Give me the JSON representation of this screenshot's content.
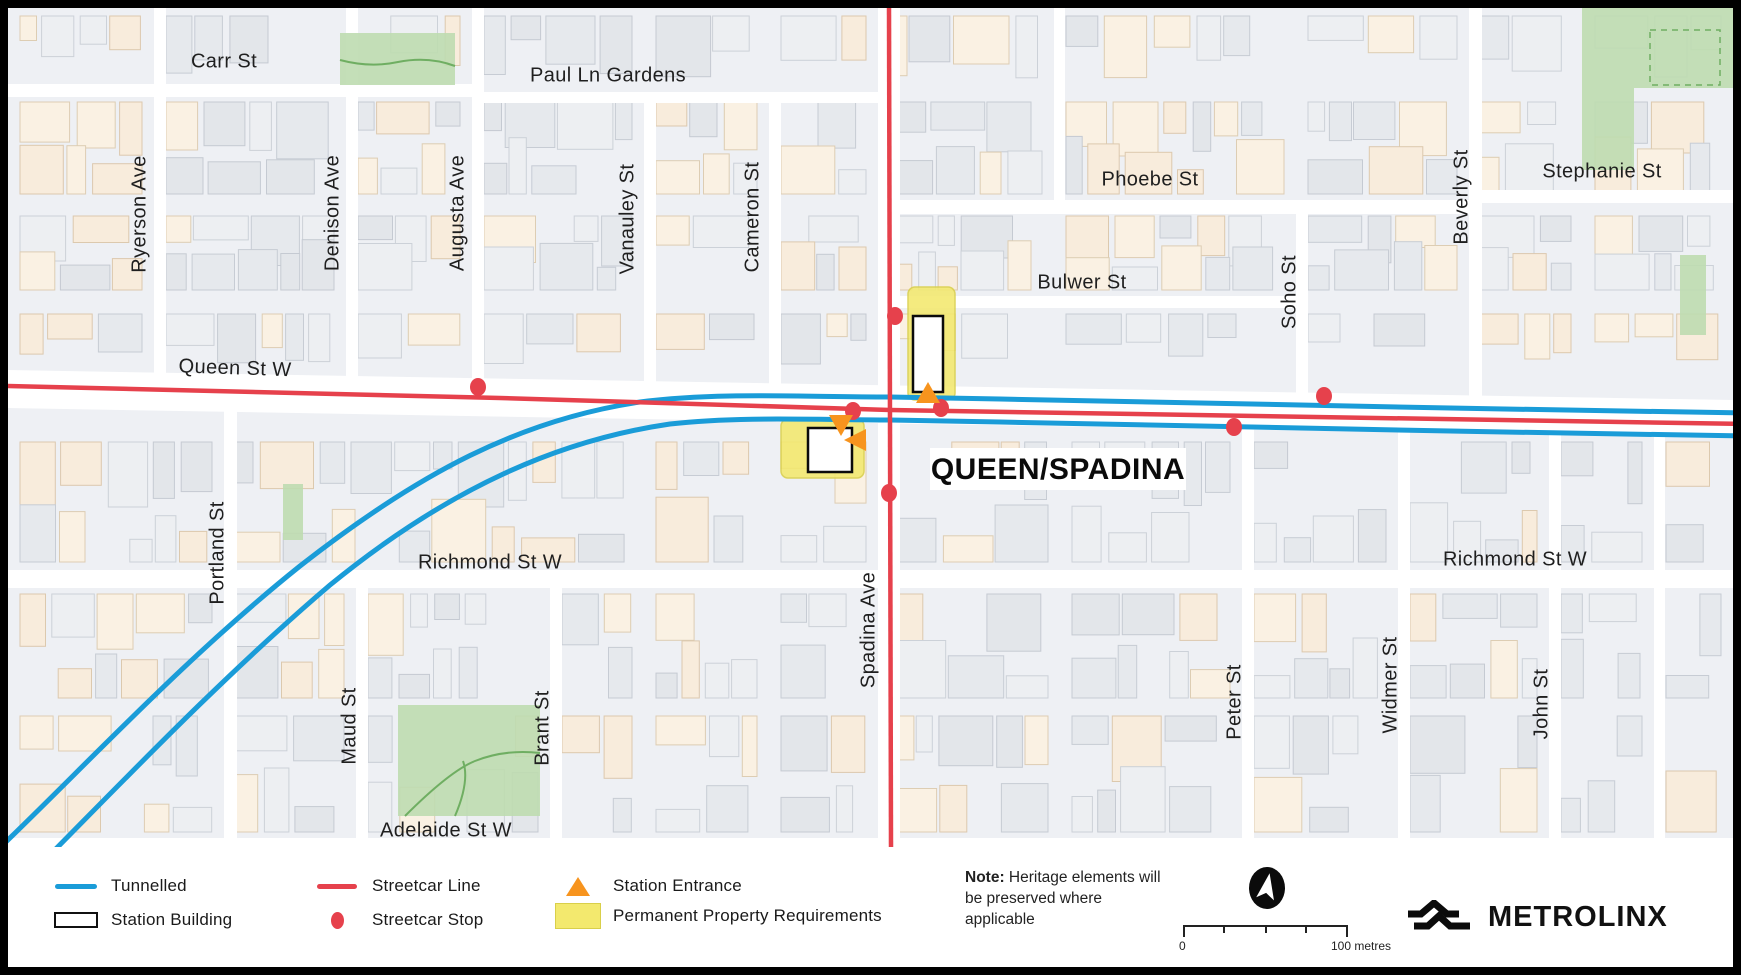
{
  "map": {
    "station_label": "QUEEN/SPADINA",
    "street_labels": [
      {
        "t": "Carr St",
        "x": 224,
        "y": 62,
        "r": 0
      },
      {
        "t": "Paul Ln Gardens",
        "x": 608,
        "y": 76,
        "r": 0
      },
      {
        "t": "Phoebe St",
        "x": 1150,
        "y": 180,
        "r": 0
      },
      {
        "t": "Stephanie St",
        "x": 1602,
        "y": 172,
        "r": 0
      },
      {
        "t": "Bulwer St",
        "x": 1082,
        "y": 283,
        "r": 0
      },
      {
        "t": "Queen St W",
        "x": 235,
        "y": 369,
        "r": 2
      },
      {
        "t": "Richmond St W",
        "x": 490,
        "y": 563,
        "r": 0
      },
      {
        "t": "Richmond St W",
        "x": 1515,
        "y": 560,
        "r": 0
      },
      {
        "t": "Adelaide St W",
        "x": 446,
        "y": 831,
        "r": 0
      },
      {
        "t": "Ryerson Ave",
        "x": 140,
        "y": 214,
        "r": -90
      },
      {
        "t": "Denison Ave",
        "x": 333,
        "y": 213,
        "r": -90
      },
      {
        "t": "Augusta Ave",
        "x": 458,
        "y": 213,
        "r": -90
      },
      {
        "t": "Vanauley St",
        "x": 628,
        "y": 219,
        "r": -90
      },
      {
        "t": "Cameron St",
        "x": 753,
        "y": 217,
        "r": -90
      },
      {
        "t": "Soho St",
        "x": 1290,
        "y": 292,
        "r": -90
      },
      {
        "t": "Beverly St",
        "x": 1462,
        "y": 197,
        "r": -90
      },
      {
        "t": "Portland St",
        "x": 218,
        "y": 553,
        "r": -90
      },
      {
        "t": "Maud St",
        "x": 350,
        "y": 726,
        "r": -90
      },
      {
        "t": "Brant St",
        "x": 543,
        "y": 728,
        "r": -90
      },
      {
        "t": "Spadina Ave",
        "x": 869,
        "y": 630,
        "r": -90
      },
      {
        "t": "Peter St",
        "x": 1235,
        "y": 702,
        "r": -90
      },
      {
        "t": "Widmer St",
        "x": 1391,
        "y": 685,
        "r": -90
      },
      {
        "t": "John St",
        "x": 1542,
        "y": 704,
        "r": -90
      }
    ],
    "markers": {
      "streetcar_stops": [
        [
          478,
          387
        ],
        [
          895,
          316
        ],
        [
          853,
          411
        ],
        [
          941,
          408
        ],
        [
          889,
          493
        ],
        [
          1234,
          427
        ],
        [
          1324,
          396
        ]
      ],
      "entrances": [
        {
          "x": 928,
          "y": 394,
          "dir": "up"
        },
        {
          "x": 841,
          "y": 424,
          "dir": "down"
        },
        {
          "x": 857,
          "y": 440,
          "dir": "left"
        }
      ],
      "station_buildings": [
        [
          913,
          316,
          30,
          76
        ],
        [
          808,
          428,
          44,
          44
        ]
      ],
      "property_areas": [
        [
          908,
          287,
          47,
          113
        ],
        [
          781,
          419,
          83,
          59
        ]
      ]
    },
    "colors": {
      "tunnelled": "#1a9cd8",
      "streetcar": "#e6414c",
      "entrance": "#f7941e",
      "property_fill": "#f3e96e",
      "property_stroke": "#d9cf4a",
      "park": "#bedcb0",
      "park_line": "#6fae62",
      "background": "#eef0f4",
      "street": "#ffffff",
      "label": "#1f1f1f"
    }
  },
  "legend": {
    "items": [
      {
        "label": "Tunnelled"
      },
      {
        "label": "Station Building"
      },
      {
        "label": "Streetcar Line"
      },
      {
        "label": "Streetcar Stop"
      },
      {
        "label": "Station Entrance"
      },
      {
        "label": "Permanent Property Requirements"
      }
    ],
    "note_bold": "Note:",
    "note_text": " Heritage elements will be preserved where applicable",
    "scale": {
      "start": "0",
      "end": "100 metres"
    },
    "logo_text": "METROLINX"
  }
}
